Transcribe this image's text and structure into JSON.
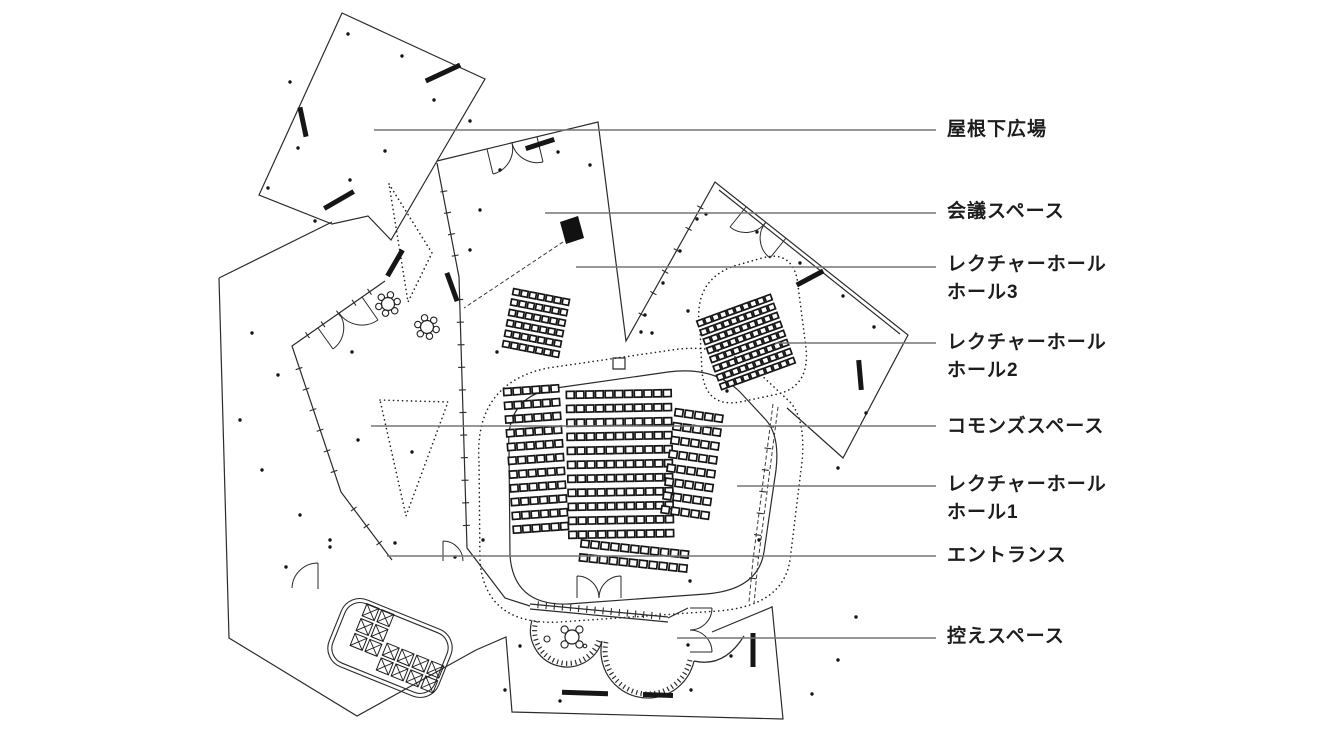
{
  "labels": [
    {
      "id": "roof-plaza",
      "line1": "屋根下広場",
      "line2": "",
      "x": 947,
      "y": 130,
      "ly": 130,
      "lx": 374
    },
    {
      "id": "meeting-space",
      "line1": "会議スペース",
      "line2": "",
      "x": 947,
      "y": 212,
      "ly": 213,
      "lx": 545
    },
    {
      "id": "lecture-hall3",
      "line1": "レクチャーホール",
      "line2": "ホール3",
      "x": 947,
      "y": 265,
      "ly": 267,
      "lx": 576
    },
    {
      "id": "lecture-hall2",
      "line1": "レクチャーホール",
      "line2": "ホール2",
      "x": 947,
      "y": 343,
      "ly": 343,
      "lx": 775
    },
    {
      "id": "commons-space",
      "line1": "コモンズスペース",
      "line2": "",
      "x": 947,
      "y": 427,
      "ly": 426,
      "lx": 371
    },
    {
      "id": "lecture-hall1",
      "line1": "レクチャーホール",
      "line2": "ホール1",
      "x": 947,
      "y": 485,
      "ly": 486,
      "lx": 737
    },
    {
      "id": "entrance",
      "line1": "エントランス",
      "line2": "",
      "x": 947,
      "y": 556,
      "ly": 556,
      "lx": 387
    },
    {
      "id": "waiting-space",
      "line1": "控えスペース",
      "line2": "",
      "x": 947,
      "y": 637,
      "ly": 638,
      "lx": 677
    }
  ],
  "plan": {
    "leader_end_x": 936,
    "colors": {
      "outline": "#2b2b2b",
      "leader": "#757575",
      "seat": "#161616",
      "dots": "#151515",
      "text": "#1d1d1d",
      "bench": "#161616"
    },
    "outlines": [
      "M342,13 L485,79 L437,161 L391,240 L368,216 L332,224 L259,195 Z",
      "M437,161 L598,122 L626,341 L715,182 L908,335 L843,458 L787,408",
      "M437,163 L459,277 L467,548 L505,598 L530,606",
      "M219,278 L332,222",
      "M219,278 L229,638 L357,716 L476,650 L506,637 L512,712 L783,719 L772,606",
      "M385,281 L292,346 L341,492 L392,560",
      "M509,448 Q505,396 556,388 L668,372 Q714,366 740,392 L766,420 Q780,436 776,470 L764,552 Q758,590 706,594 L568,604 Q514,606 510,556 Z",
      "M719,190 L900,334",
      "M668,618 L688,608 M712,632 L772,607",
      "M530,604 L668,617 M530,609 L668,622",
      "M613,358 h12 v11 h-12 Z",
      "M694,661 Q724,668 744,636"
    ],
    "scallop_arcs": [
      {
        "outer": "M532,620 A36,36 0 0 0 602,641",
        "hatch": "M536,621 A32,32 0 0 0 599,640"
      },
      {
        "outer": "M602,641 A46,46 0 0 0 694,661",
        "hatch": "M606,642 A42,42 0 0 0 690,660"
      }
    ],
    "dotted_paths": [
      "M479,462 Q474,383 548,368 L672,350 Q724,342 758,372 L790,402 Q806,420 802,462 L790,560 Q783,606 718,611 L560,622 Q486,626 480,562 Z",
      "M700,330 Q692,281 734,266 L762,258 Q790,250 797,278 L806,348 Q810,386 778,394 L740,402 Q706,408 702,372 Z",
      "M389,184 L432,253 L408,302 Z",
      "M380,400 L448,402 L406,516 Z"
    ],
    "dashed_paths": [
      "M773,404 L753,560 L749,602",
      "M778,407 L758,562 L754,604",
      "M563,242 L464,308"
    ],
    "door_paths": [
      "M487,149 L493,174 M512,143 A26,26 0 0 1 493,174",
      "M537,137 L543,162 M512,143 A26,26 0 0 0 543,162",
      "M746,207 L730,227 M766,222 A25,25 0 0 1 730,227",
      "M786,238 L770,258 M766,222 A25,25 0 0 0 770,258",
      "M318,328 L333,349 M339,313 A26,26 0 0 1 333,349",
      "M362,297 L378,320 M339,313 A28,28 0 0 0 378,320",
      "M292,588 A26,26 0 0 1 318,563 M318,563 L318,589",
      "M577,598 L577,576 M599,598 A22,22 0 0 0 577,576",
      "M621,598 L621,576 M599,598 A22,22 0 0 1 621,576",
      "M690,608 L712,608 M690,630 A22,22 0 0 0 712,608",
      "M690,652 L712,652 M690,630 A22,22 0 0 1 712,652",
      "M443,541 L443,561 M443,541 A20,20 0 0 1 463,561"
    ],
    "tick_walls": [
      {
        "x1": 459,
        "y1": 277,
        "x2": 467,
        "y2": 548,
        "count": 11
      },
      {
        "x1": 440,
        "y1": 170,
        "x2": 459,
        "y2": 277,
        "count": 4
      },
      {
        "x1": 292,
        "y1": 346,
        "x2": 385,
        "y2": 281,
        "count": 5
      },
      {
        "x1": 292,
        "y1": 348,
        "x2": 341,
        "y2": 492,
        "count": 6
      },
      {
        "x1": 341,
        "y1": 492,
        "x2": 392,
        "y2": 560,
        "count": 3
      },
      {
        "x1": 630,
        "y1": 336,
        "x2": 712,
        "y2": 186,
        "count": 6
      },
      {
        "x1": 773,
        "y1": 405,
        "x2": 750,
        "y2": 600,
        "count": 8
      },
      {
        "x1": 530,
        "y1": 604,
        "x2": 668,
        "y2": 617,
        "count": 16
      }
    ],
    "seat_blocks": [
      {
        "name": "hall3-seats",
        "cols": 7,
        "rows": 6,
        "px": 8.4,
        "py": 10.6,
        "sw": 6.5,
        "sh": 6,
        "cx": 536,
        "cy": 323,
        "rot": 11
      },
      {
        "name": "hall2-seats",
        "cols": 10,
        "rows": 8,
        "px": 8,
        "py": 9.6,
        "sw": 6.3,
        "sh": 5.8,
        "cx": 746,
        "cy": 342,
        "rot": -20
      },
      {
        "name": "hall1-seats-left",
        "cols": 6,
        "rows": 11,
        "px": 9.5,
        "py": 13.8,
        "sw": 7.6,
        "sh": 7,
        "cx": 536,
        "cy": 459,
        "rot": -4
      },
      {
        "name": "hall1-seats-center",
        "cols": 11,
        "rows": 11,
        "px": 9.7,
        "py": 14,
        "sw": 7.8,
        "sh": 7,
        "cx": 620,
        "cy": 464,
        "rot": -1
      },
      {
        "name": "hall1-seats-right",
        "cols": 5,
        "rows": 8,
        "px": 10,
        "py": 14,
        "sw": 7.8,
        "sh": 7,
        "cx": 692,
        "cy": 464,
        "rot": 8
      },
      {
        "name": "hall1-seats-bottom",
        "cols": 11,
        "rows": 2,
        "px": 10,
        "py": 14,
        "sw": 7.8,
        "sh": 7,
        "cx": 634,
        "cy": 556,
        "rot": 6
      }
    ],
    "restroom": {
      "outer": {
        "x": 331,
        "y": 612,
        "w": 118,
        "h": 72,
        "rx": 20
      },
      "inner": {
        "x": 335,
        "y": 616,
        "w": 110,
        "h": 64,
        "rx": 16
      },
      "rot": 22,
      "cx": 390,
      "cy": 648
    },
    "xbox_blocks": [
      {
        "cols": 2,
        "rows": 3,
        "p": 16,
        "s": 13,
        "cx": 372,
        "cy": 630,
        "rot": 22
      },
      {
        "cols": 4,
        "rows": 2,
        "p": 16,
        "s": 13,
        "cx": 410,
        "cy": 668,
        "rot": 22
      }
    ],
    "benches": [
      [
        443,
        73,
        -25,
        38
      ],
      [
        540,
        144,
        -18,
        30
      ],
      [
        303,
        122,
        78,
        30
      ],
      [
        339,
        200,
        -30,
        34
      ],
      [
        395,
        263,
        -60,
        30
      ],
      [
        452,
        287,
        70,
        30
      ],
      [
        810,
        278,
        -28,
        30
      ],
      [
        860,
        375,
        85,
        30
      ],
      [
        585,
        693,
        2,
        46
      ],
      [
        658,
        695,
        2,
        30
      ],
      [
        753,
        650,
        90,
        34
      ]
    ],
    "tables": [
      {
        "cx": 388,
        "cy": 304,
        "r": 6.5,
        "petals": 6,
        "pr": 3.2,
        "pd": 9.5,
        "a0": -15
      },
      {
        "cx": 427,
        "cy": 327,
        "r": 6.5,
        "petals": 6,
        "pr": 3.2,
        "pd": 9.5,
        "a0": 15
      },
      {
        "cx": 572,
        "cy": 637,
        "r": 7,
        "petals": 4,
        "pr": 3.6,
        "pd": 10.5,
        "a0": 45
      }
    ],
    "circles": [
      {
        "cx": 547,
        "cy": 639,
        "r": 3
      },
      {
        "cx": 585,
        "cy": 646,
        "r": 1.8
      }
    ],
    "black_quad": "560,222 578,216 584,238 566,244",
    "dots": [
      [
        348,
        34
      ],
      [
        402,
        56
      ],
      [
        290,
        82
      ],
      [
        434,
        100
      ],
      [
        470,
        121
      ],
      [
        298,
        148
      ],
      [
        385,
        151
      ],
      [
        350,
        180
      ],
      [
        268,
        188
      ],
      [
        315,
        221
      ],
      [
        500,
        170
      ],
      [
        558,
        152
      ],
      [
        590,
        165
      ],
      [
        470,
        250
      ],
      [
        480,
        210
      ],
      [
        706,
        214
      ],
      [
        757,
        232
      ],
      [
        800,
        263
      ],
      [
        843,
        296
      ],
      [
        874,
        327
      ],
      [
        688,
        311
      ],
      [
        652,
        333
      ],
      [
        727,
        391
      ],
      [
        838,
        468
      ],
      [
        866,
        413
      ],
      [
        645,
        315
      ],
      [
        663,
        283
      ],
      [
        680,
        251
      ],
      [
        697,
        219
      ],
      [
        240,
        420
      ],
      [
        262,
        470
      ],
      [
        300,
        515
      ],
      [
        330,
        547
      ],
      [
        286,
        567
      ],
      [
        252,
        333
      ],
      [
        278,
        375
      ],
      [
        352,
        352
      ],
      [
        358,
        440
      ],
      [
        412,
        452
      ],
      [
        330,
        540
      ],
      [
        395,
        543
      ],
      [
        455,
        557
      ],
      [
        497,
        352
      ],
      [
        641,
        332
      ],
      [
        483,
        540
      ],
      [
        759,
        540
      ],
      [
        690,
        581
      ],
      [
        520,
        646
      ],
      [
        505,
        690
      ],
      [
        560,
        701
      ],
      [
        688,
        645
      ],
      [
        691,
        690
      ],
      [
        731,
        656
      ],
      [
        838,
        660
      ],
      [
        812,
        694
      ],
      [
        856,
        617
      ]
    ]
  }
}
